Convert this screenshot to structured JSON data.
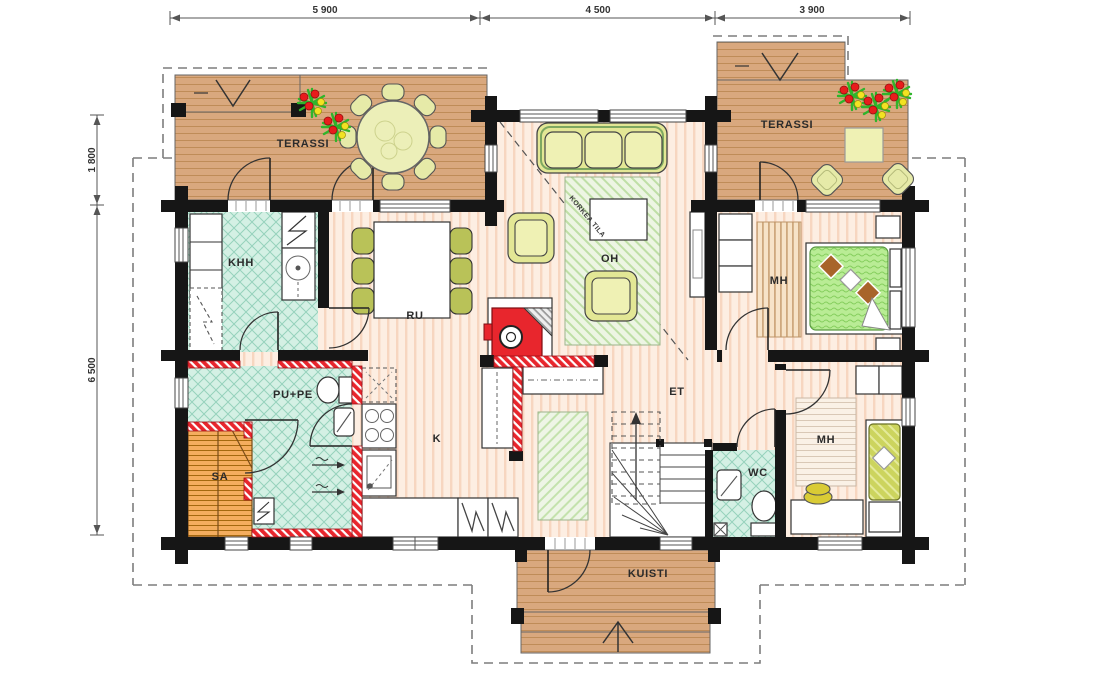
{
  "dimensions": {
    "top": [
      "5 900",
      "4 500",
      "3 900"
    ],
    "left": [
      "1 800",
      "6 500"
    ]
  },
  "rooms": {
    "terassi_left": "TERASSI",
    "terassi_right": "TERASSI",
    "khh": "KHH",
    "ru": "RU",
    "oh": "OH",
    "korkea_tila": "KORKEA TILA",
    "mh_top": "MH",
    "mh_bottom": "MH",
    "pu_pe": "PU+PE",
    "sa": "SA",
    "k": "K",
    "et": "ET",
    "wc": "WC",
    "kuisti": "KUISTI"
  },
  "colors": {
    "wall": "#161616",
    "deck_wood": "#d9a87e",
    "deck_line": "#bf8c58",
    "interior_floor": "#fdeee2",
    "floor_stripe": "#f7d6c0",
    "wet_tile": "#d4f0e4",
    "tile_line": "#96d2bc",
    "wet_wall_red": "#e8262d",
    "sauna_bench": "#f4ad5e",
    "furniture_yellow": "#eff1b4",
    "chair_olive": "#b9c258",
    "bed_green": "#b9ec95",
    "bed_olive": "#ccd45e",
    "plant_green": "#2fb52b",
    "berry_red": "#e81c1c",
    "berry_yellow": "#f2e222",
    "roof_dash": "#7d7d7d"
  }
}
